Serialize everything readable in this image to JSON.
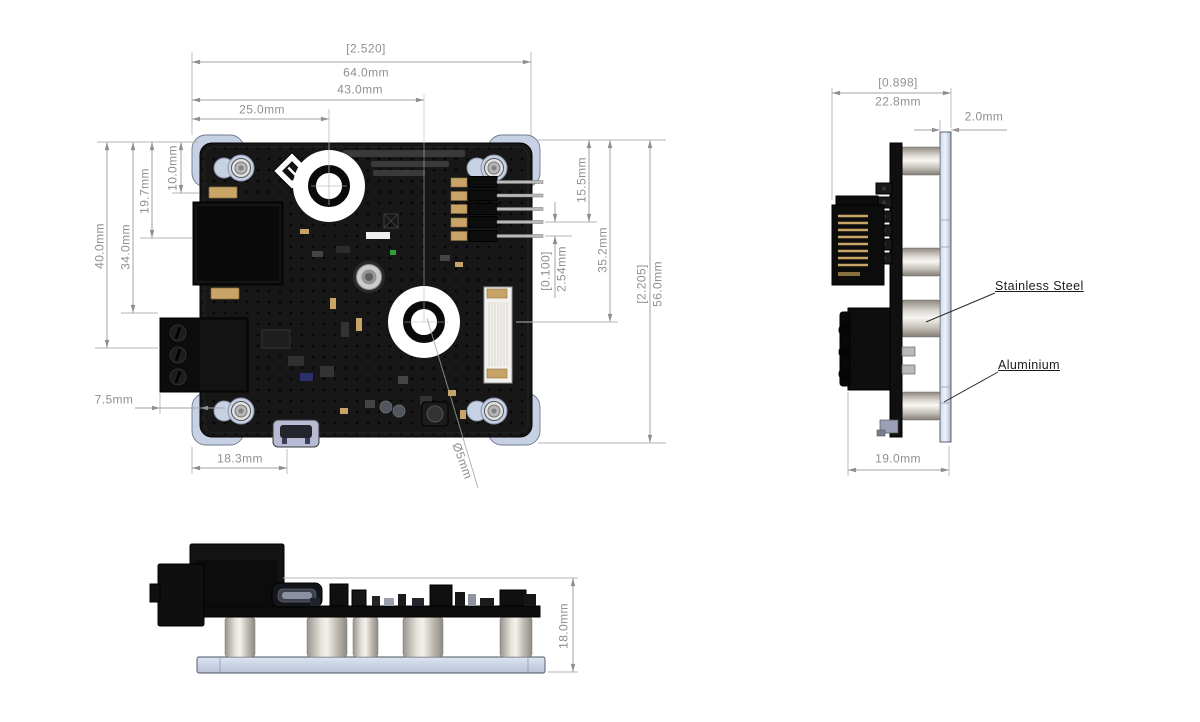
{
  "dims": {
    "top": {
      "overall_width_in": "[2.520]",
      "overall_width_mm": "64.0mm",
      "width_43": "43.0mm",
      "width_25": "25.0mm",
      "height_40": "40.0mm",
      "height_34": "34.0mm",
      "height_19_7": "19.7mm",
      "height_10": "10.0mm",
      "offset_7_5": "7.5mm",
      "usb_offset": "18.3mm",
      "hole_diameter": "Ø5mm",
      "height_15_5": "15.5mm",
      "height_35_2": "35.2mm",
      "pin_pitch_in": "[0.100]",
      "pin_pitch_mm": "2.54mm",
      "overall_height_in": "[2.205]",
      "overall_height_mm": "56.0mm"
    },
    "side": {
      "overall_depth_in": "[0.898]",
      "overall_depth_mm": "22.8mm",
      "plate_thickness": "2.0mm",
      "depth_19": "19.0mm"
    },
    "front": {
      "overall_height": "18.0mm"
    },
    "materials": {
      "standoff": "Stainless Steel",
      "plate": "Aluminium"
    }
  },
  "colors": {
    "dimension_gray": "#8f8f8f",
    "aluminium_plate": "#c7d1e4",
    "stainless_steel": "#d9d5cf",
    "pcb_black": "#161616",
    "gold_pad": "#c9a467"
  }
}
